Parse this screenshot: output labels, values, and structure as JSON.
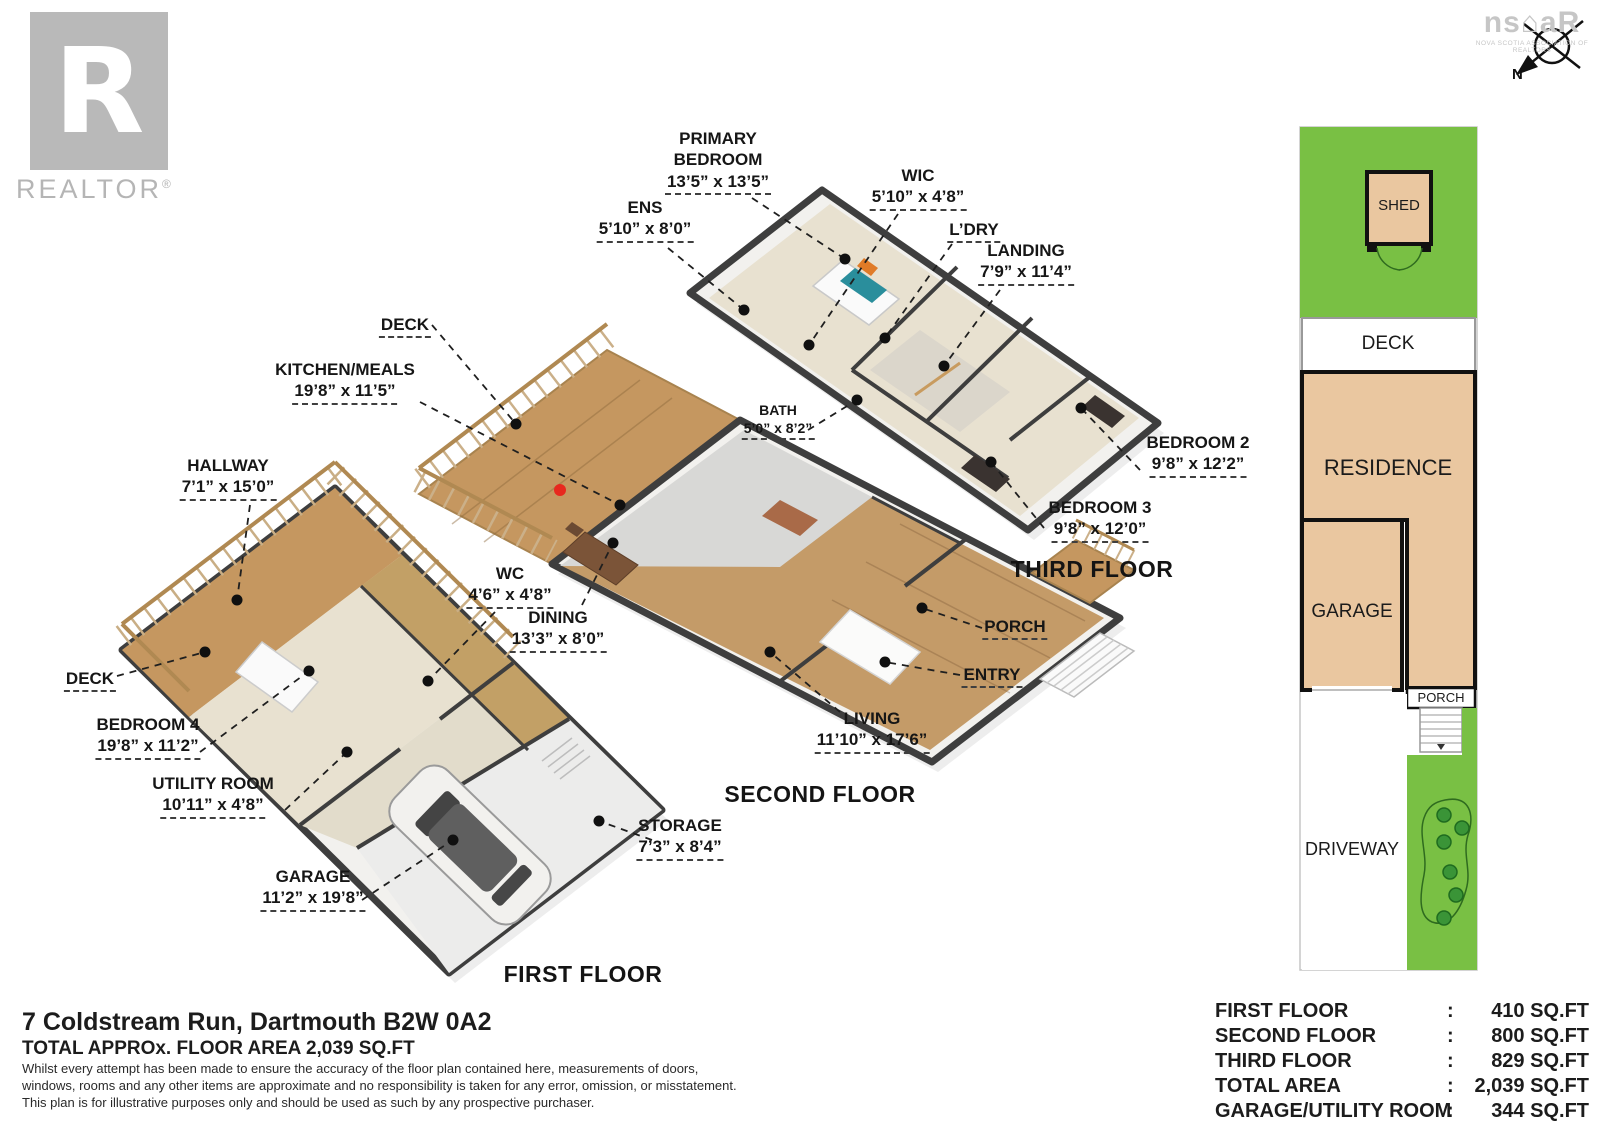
{
  "branding": {
    "realtor_logo": {
      "letter": "R",
      "wordmark": "REALTOR",
      "registered": "®"
    },
    "nsar_logo": {
      "text": "ns⌂aR",
      "caption": "NOVA SCOTIA ASSOCIATION OF REALTORS"
    },
    "compass": {
      "north_label": "N"
    }
  },
  "floors": {
    "third": {
      "title": "THIRD FLOOR",
      "rooms": [
        {
          "name": "PRIMARY BEDROOM",
          "dims": "13’5” x 13’5”"
        },
        {
          "name": "ENS",
          "dims": "5’10” x 8’0”"
        },
        {
          "name": "WIC",
          "dims": "5’10” x 4’8”"
        },
        {
          "name": "L’DRY"
        },
        {
          "name": "LANDING",
          "dims": "7’9” x 11’4”"
        },
        {
          "name": "BATH",
          "dims": "5’0” x 8’2”"
        },
        {
          "name": "BEDROOM 2",
          "dims": "9’8” x 12’2”"
        },
        {
          "name": "BEDROOM 3",
          "dims": "9’8” x 12’0”"
        }
      ]
    },
    "second": {
      "title": "SECOND FLOOR",
      "rooms": [
        {
          "name": "DECK"
        },
        {
          "name": "KITCHEN/MEALS",
          "dims": "19’8” x 11’5”"
        },
        {
          "name": "DINING",
          "dims": "13’3” x 8’0”"
        },
        {
          "name": "LIVING",
          "dims": "11’10” x 17’6”"
        },
        {
          "name": "PORCH"
        },
        {
          "name": "ENTRY"
        }
      ]
    },
    "first": {
      "title": "FIRST FLOOR",
      "rooms": [
        {
          "name": "HALLWAY",
          "dims": "7’1” x 15’0”"
        },
        {
          "name": "DECK"
        },
        {
          "name": "BEDROOM 4",
          "dims": "19’8” x 11’2”"
        },
        {
          "name": "WC",
          "dims": "4’6” x 4’8”"
        },
        {
          "name": "UTILITY ROOM",
          "dims": "10’11” x 4’8”"
        },
        {
          "name": "GARAGE",
          "dims": "11’2” x 19’8”"
        },
        {
          "name": "STORAGE",
          "dims": "7’3” x 8’4”"
        }
      ]
    }
  },
  "site_plan": {
    "labels": {
      "shed": "SHED",
      "deck": "DECK",
      "residence": "RESIDENCE",
      "garage": "GARAGE",
      "porch": "PORCH",
      "driveway": "DRIVEWAY"
    }
  },
  "footer": {
    "address": "7 Coldstream Run, Dartmouth B2W 0A2",
    "total_line": "TOTAL APPROx. FLOOR AREA 2,039 SQ.FT",
    "disclaimer_1": "Whilst every attempt has been made to ensure the accuracy of the floor plan contained here, measurements of doors,",
    "disclaimer_2": "windows, rooms and any other items are approximate and no responsibility is taken for any error, omission, or misstatement.",
    "disclaimer_3": "This plan is for illustrative purposes only and should be used as such by any prospective purchaser."
  },
  "area_table": {
    "rows": [
      {
        "label": "FIRST FLOOR",
        "sep": ":",
        "value": "410 SQ.FT"
      },
      {
        "label": "SECOND FLOOR",
        "sep": ":",
        "value": "800 SQ.FT"
      },
      {
        "label": "THIRD FLOOR",
        "sep": ":",
        "value": "829 SQ.FT"
      },
      {
        "label": "TOTAL AREA",
        "sep": ":",
        "value": "2,039 SQ.FT"
      },
      {
        "label": "GARAGE/UTILITY ROOM",
        "sep": ":",
        "value": "344 SQ.FT"
      }
    ]
  },
  "colors": {
    "lawn_green": "#79C044",
    "building_tan": "#EAC7A0",
    "wall_dark": "#3E3E3E",
    "deck_wood": "#C59760",
    "floor_wood": "#C49B68",
    "floor_beige": "#E8E1D0",
    "accent_red": "#E8281E"
  }
}
